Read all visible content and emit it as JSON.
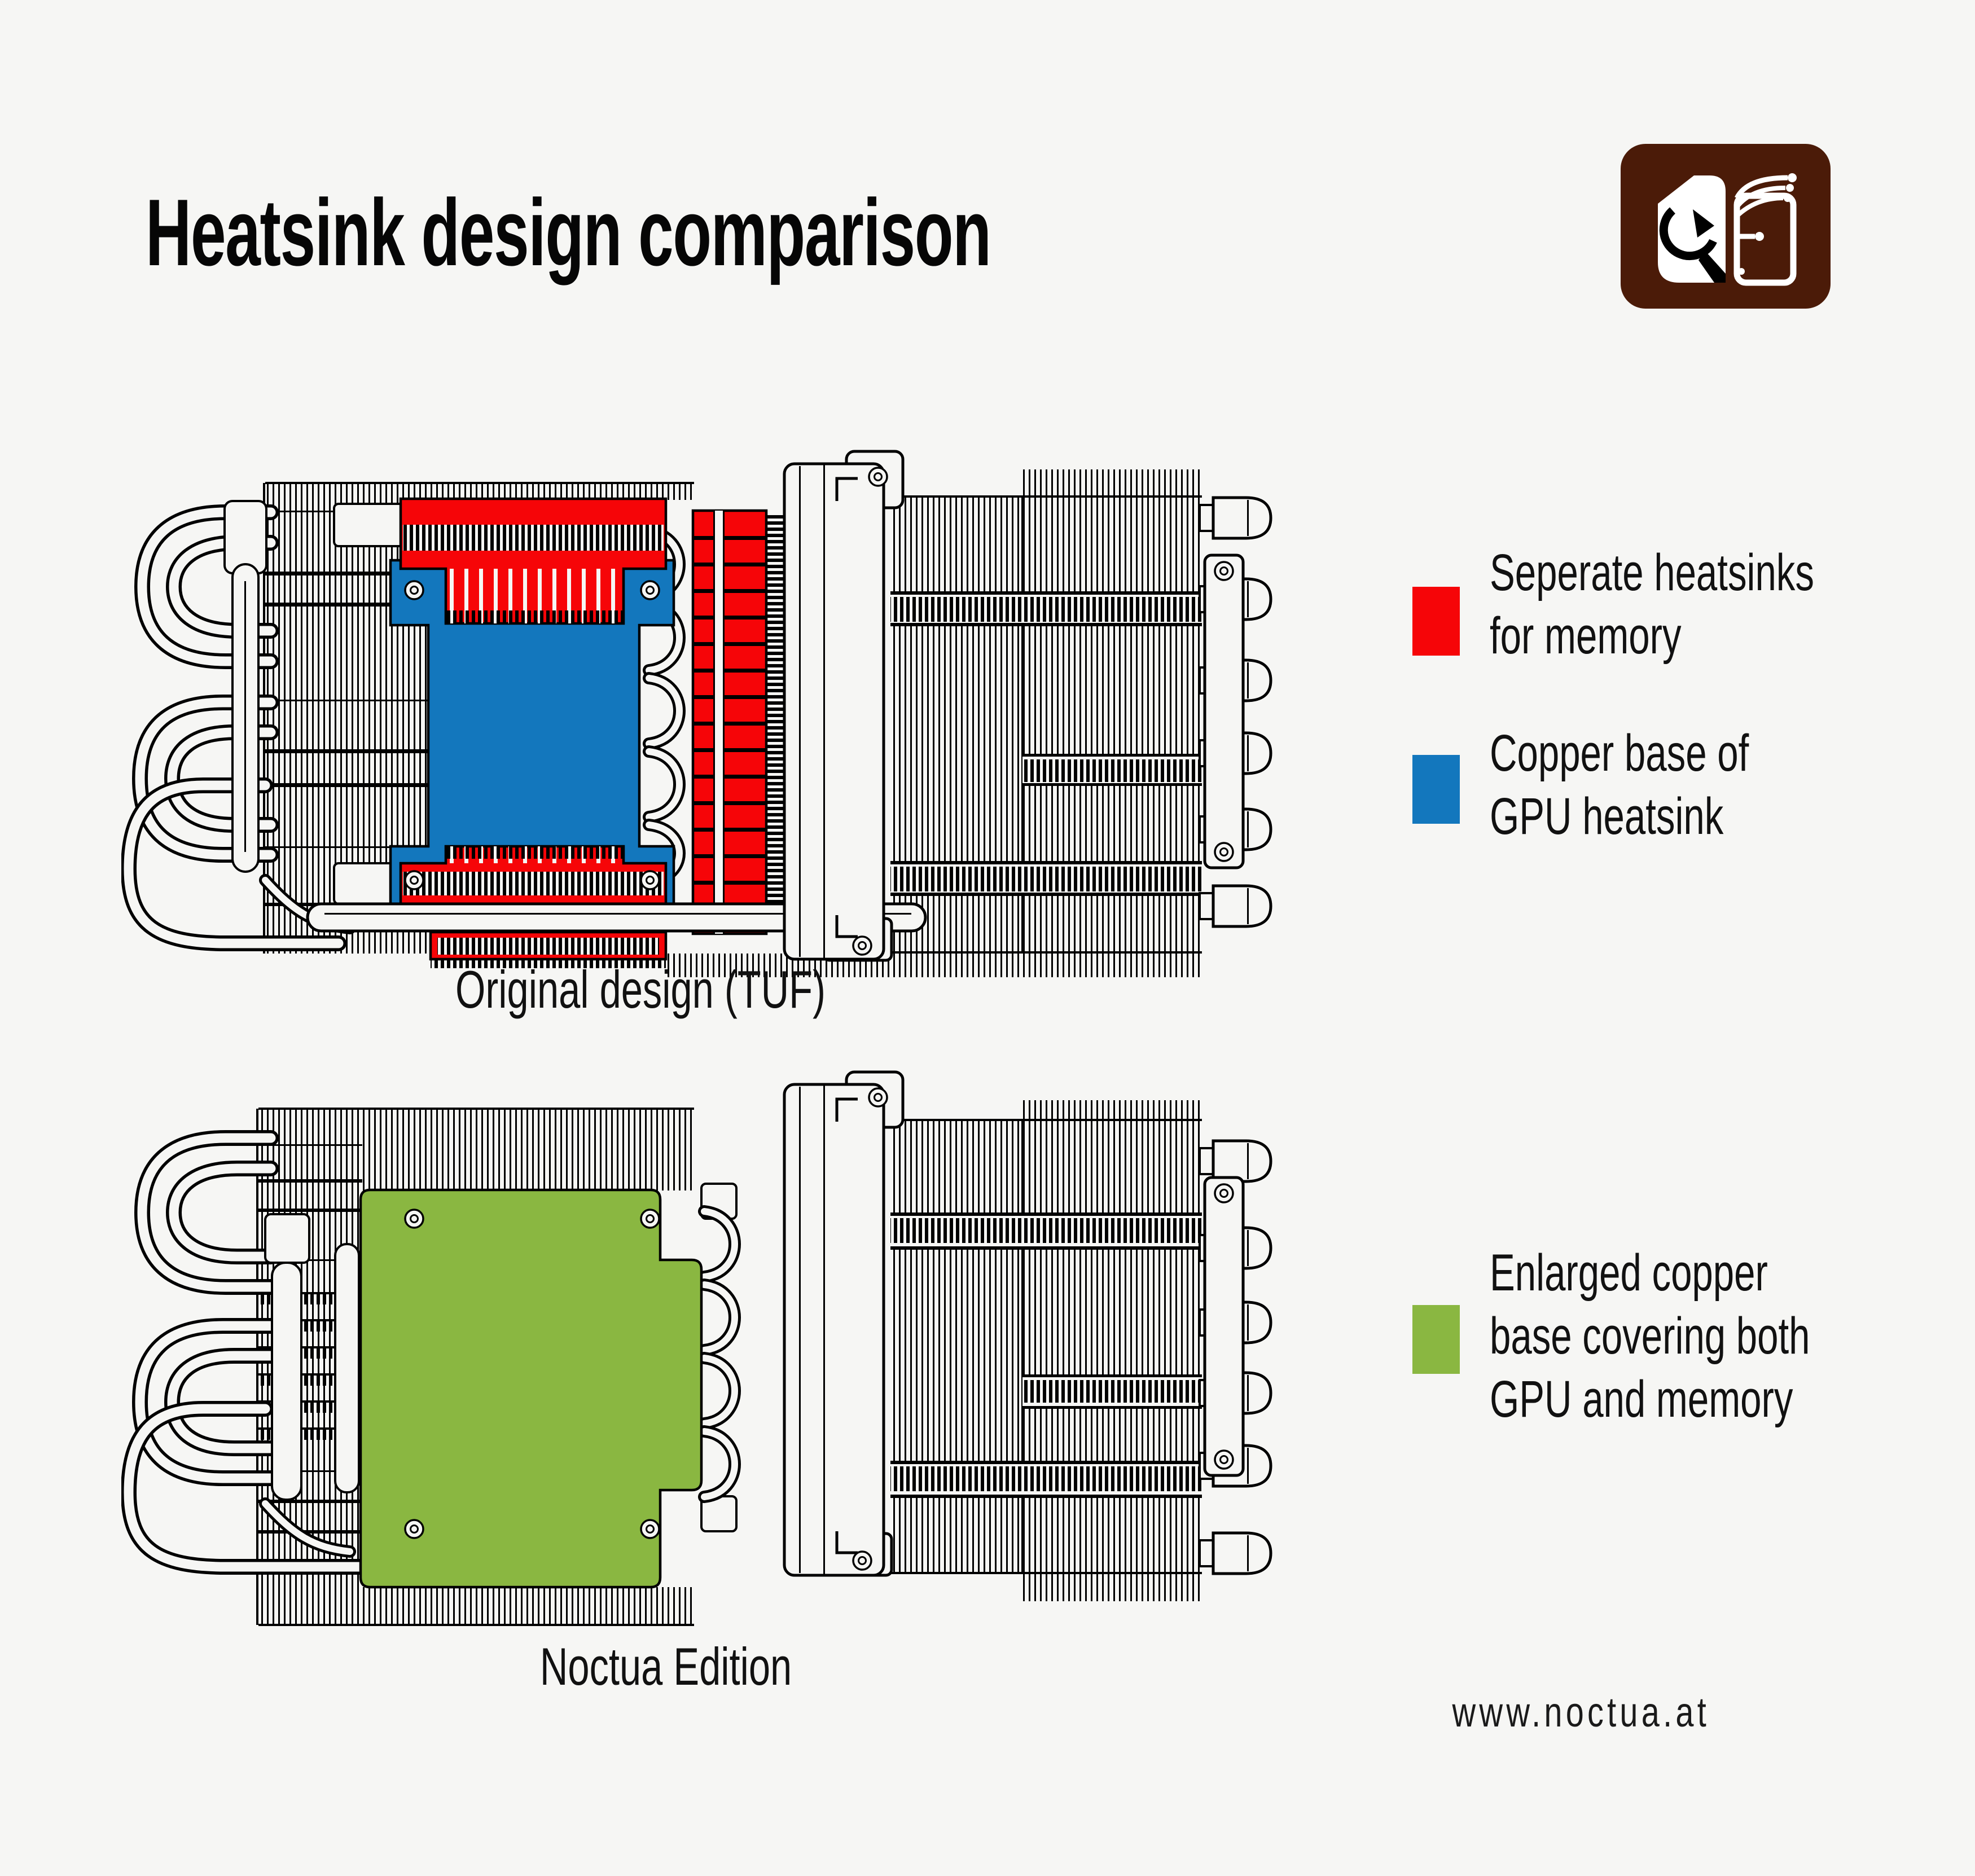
{
  "page": {
    "background": "#f6f6f4"
  },
  "title": "Heatsink design comparison",
  "logo": {
    "label": "Noctua logo",
    "color": "#4b1b08"
  },
  "colors": {
    "memory_red": "#f60508",
    "gpu_base_blue": "#1377bd",
    "copper_green": "#8ab741",
    "ink": "#000000"
  },
  "legend": {
    "items": [
      {
        "id": "separate-heatsinks",
        "color": "#f60508",
        "lines": [
          "Seperate heatsinks",
          "for memory"
        ]
      },
      {
        "id": "gpu-copper-base",
        "color": "#1377bd",
        "lines": [
          "Copper base of",
          "GPU heatsink"
        ]
      },
      {
        "id": "enlarged-copper-base",
        "color": "#8ab741",
        "lines": [
          "Enlarged copper",
          "base covering both",
          "GPU and memory"
        ]
      }
    ]
  },
  "diagrams": [
    {
      "id": "original-tuf",
      "caption": "Original design (TUF)"
    },
    {
      "id": "noctua-edition",
      "caption": "Noctua Edition"
    }
  ],
  "footer": {
    "website": "www.noctua.at"
  }
}
